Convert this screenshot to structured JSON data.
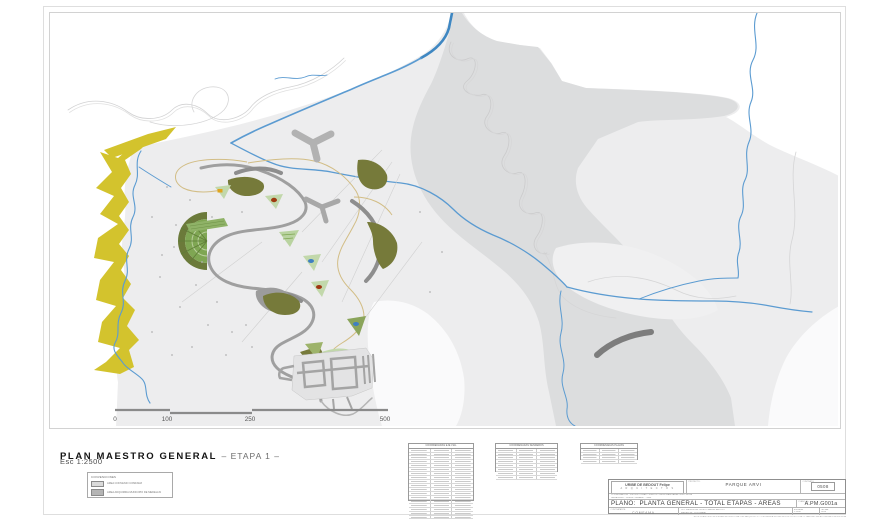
{
  "sheet": {
    "title": "PLAN MAESTRO GENERAL",
    "title_suffix": "– ETAPA 1 –",
    "scale_note": "Esc 1:2500"
  },
  "map": {
    "colors": {
      "terrain_light": "#ededee",
      "terrain_dark": "#dcddde",
      "water_blue": "#5b9bd1",
      "buffer_yellow": "#d3c32d",
      "vegetation_olive": "#767a3a",
      "vegetation_green": "#7fa653",
      "road_gray": "#9e9e9e"
    },
    "scale_bar": {
      "labels": [
        "0",
        "100",
        "250",
        "500"
      ]
    }
  },
  "legend": {
    "title": "CONVENCIONES",
    "items": [
      {
        "label": "AREA CONVENIO COMFAMA",
        "swatch": "#dadada"
      },
      {
        "label": "AREA ADQUIRIDA MUNICIPIO DE MEDELLIN",
        "swatch": "#b4b4b4"
      }
    ]
  },
  "coordinate_tables": [
    {
      "header": "COORDENADAS EJE VIAL",
      "rows": 18
    },
    {
      "header": "COORDENADAS SENDEROS",
      "rows": 8
    },
    {
      "header": "COORDENADAS PLAZAS",
      "rows": 4
    }
  ],
  "title_block": {
    "architect_name": "URIBE DE BEDOUT Felipe",
    "architect_sub": "A R Q U I T E C T O S",
    "consultants_line1": "COORDINACION - ESTRUCTURAS - SUELOS - HIDROSANITARIA - ELECTRICA",
    "consultants_line2": "PAISAJISMO - DISEÑO URBANO - VIAS",
    "project_label": "PROYECTO:",
    "project_line1": "PARQUE ARVI",
    "project_line2": "NUCLEO COMFAMA",
    "contract_label": "CONTRATO:",
    "contract_number": "0508",
    "plano_label": "PLANO:",
    "plano_title": "PLANTA GENERAL - TOTAL ETAPAS - AREAS",
    "sheet_label": "PLANO No.",
    "sheet_code": "A.PM.G001a",
    "client_label": "CONTRATANTE:",
    "client": "COMFAMA",
    "address_line1": "CLL 10A SUR No. 30-50 LOMA DE BEDOUT",
    "address_line2": "MEDELLIN - COLOMBIA",
    "scale_label": "ESCALA:",
    "scale_value": "1:2500",
    "date_label": "FECHA:",
    "date_value": "05.08",
    "footer_note": "ESTE PLANO ES PROPIEDAD INTELECTUAL DEL ARQUITECTO - PROHIBIDA SU REPRODUCCION TOTAL O PARCIAL SIN AUTORIZACION ESCRITA"
  }
}
